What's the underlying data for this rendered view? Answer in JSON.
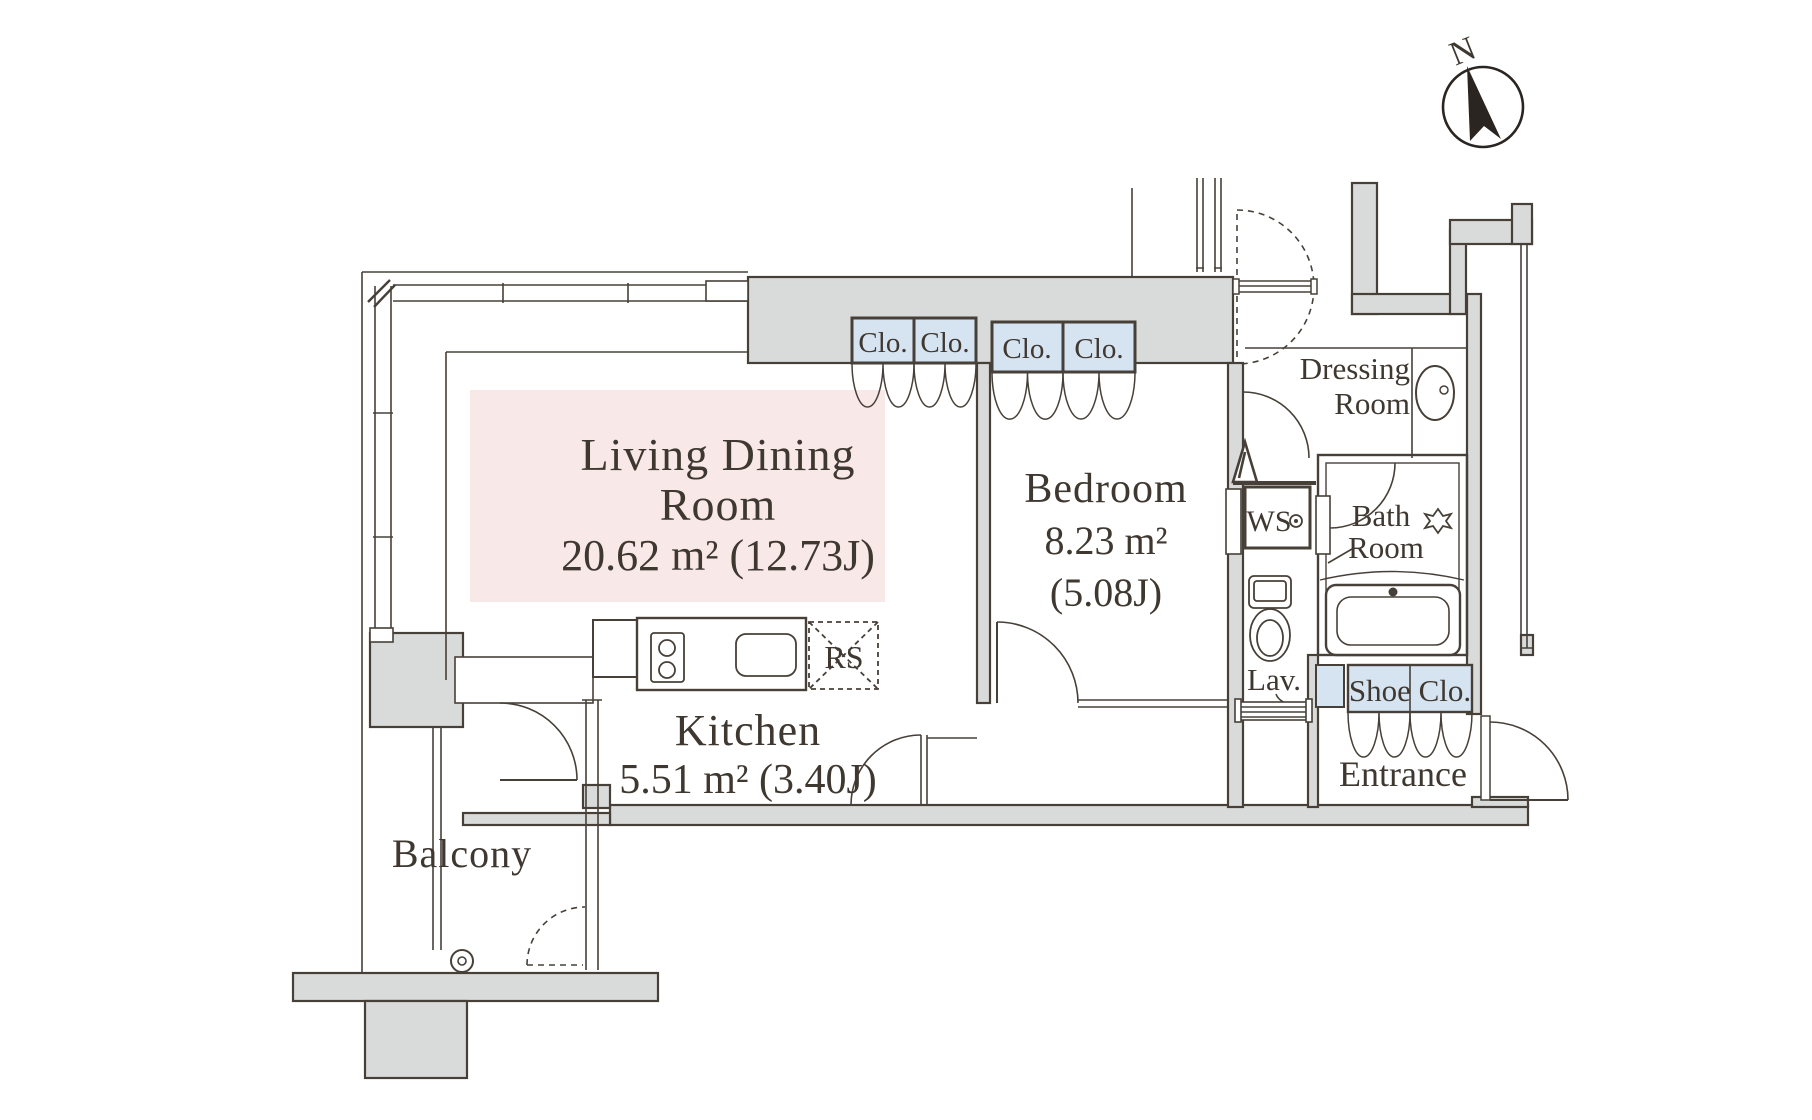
{
  "plan": {
    "type": "apartment-floor-plan",
    "colors": {
      "wall_fill": "#d9dada",
      "outline": "#474038",
      "living_highlight": "#f9e8e8",
      "closet_fill": "#d6e3f1",
      "text": "#3f3831",
      "background": "#ffffff"
    },
    "compass": {
      "label": "N"
    },
    "rooms": {
      "living_dining": {
        "line1": "Living Dining",
        "line2": "Room",
        "area": "20.62 m² (12.73J)"
      },
      "kitchen": {
        "name": "Kitchen",
        "area": "5.51 m² (3.40J)"
      },
      "bedroom": {
        "name": "Bedroom",
        "area1": "8.23 m²",
        "area2": "(5.08J)"
      },
      "balcony": {
        "name": "Balcony"
      },
      "dressing": {
        "line1": "Dressing",
        "line2": "Room"
      },
      "bath": {
        "line1": "Bath",
        "line2": "Room"
      },
      "lavatory": {
        "name": "Lav."
      },
      "entrance": {
        "name": "Entrance"
      },
      "washing_space": {
        "name": "WS"
      },
      "refrigerator_space": {
        "name": "RS"
      },
      "shoe_closet": {
        "name": "Shoe Clo."
      },
      "closets": {
        "a": "Clo.",
        "b": "Clo.",
        "c": "Clo.",
        "d": "Clo."
      }
    },
    "fixtures": [
      "north-compass",
      "kitchen-stove",
      "kitchen-sink",
      "bathtub",
      "toilet",
      "wash-basin",
      "washer-faucet",
      "bath-faucet",
      "water-heater"
    ]
  }
}
